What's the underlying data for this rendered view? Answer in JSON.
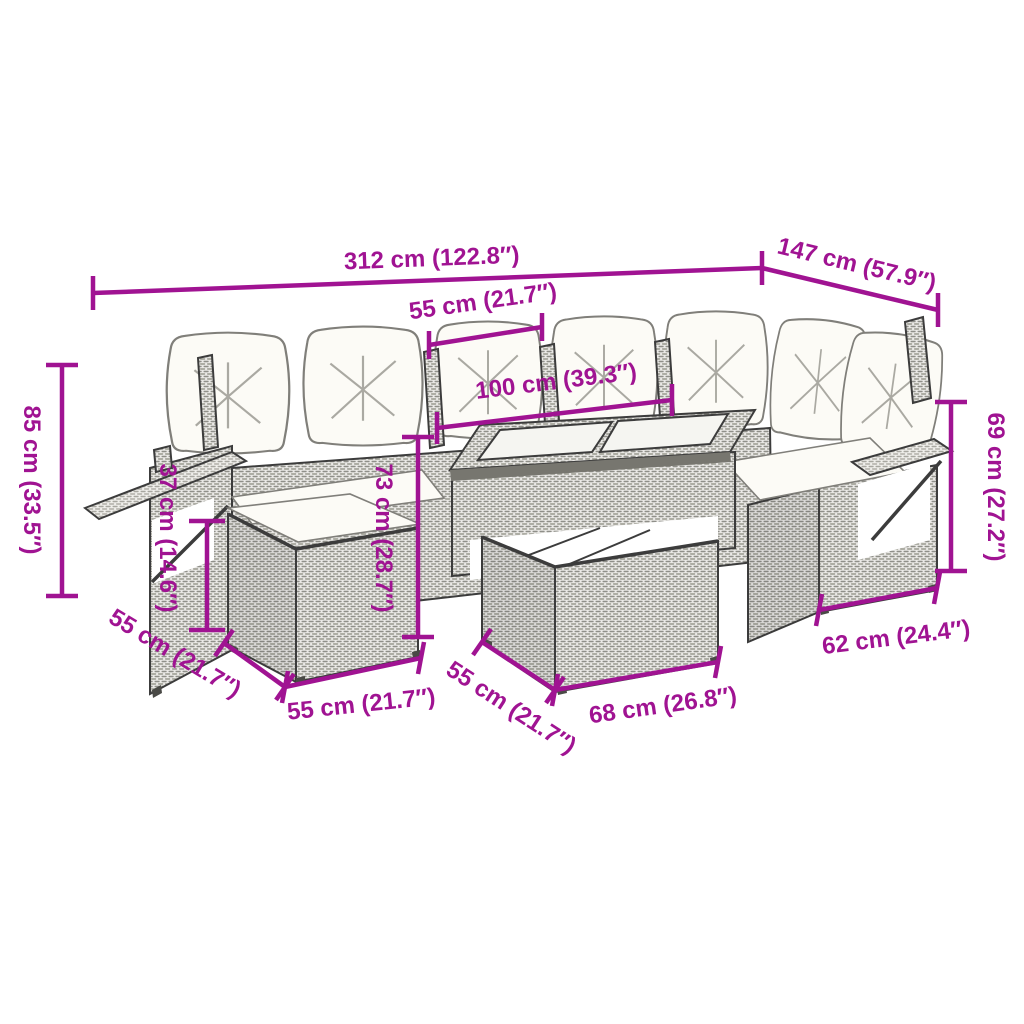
{
  "diagram": {
    "product": "Rattan garden lounge set with cushions, fold-out side trays, stool and glass-top table",
    "background_color": "#ffffff",
    "accent_color": "#a01392",
    "outline_color": "#3c3c3c",
    "cushion_color": "#fcfbf6",
    "dimensions": {
      "overall_width": "312 cm (122.8″)",
      "overall_depth": "147 cm (57.9″)",
      "seat_width": "55 cm (21.7″)",
      "table_top_length": "100 cm (39.3″)",
      "overall_height": "85 cm (33.5″)",
      "stool_height": "37 cm (14.6″)",
      "table_height": "73 cm (28.7″)",
      "sofa_height": "69 cm (27.2″)",
      "stool_depth": "55 cm (21.7″)",
      "stool_width": "55 cm (21.7″)",
      "table_depth": "55 cm (21.7″)",
      "table_width": "68 cm (26.8″)",
      "right_seat_width": "62 cm (24.4″)"
    }
  }
}
